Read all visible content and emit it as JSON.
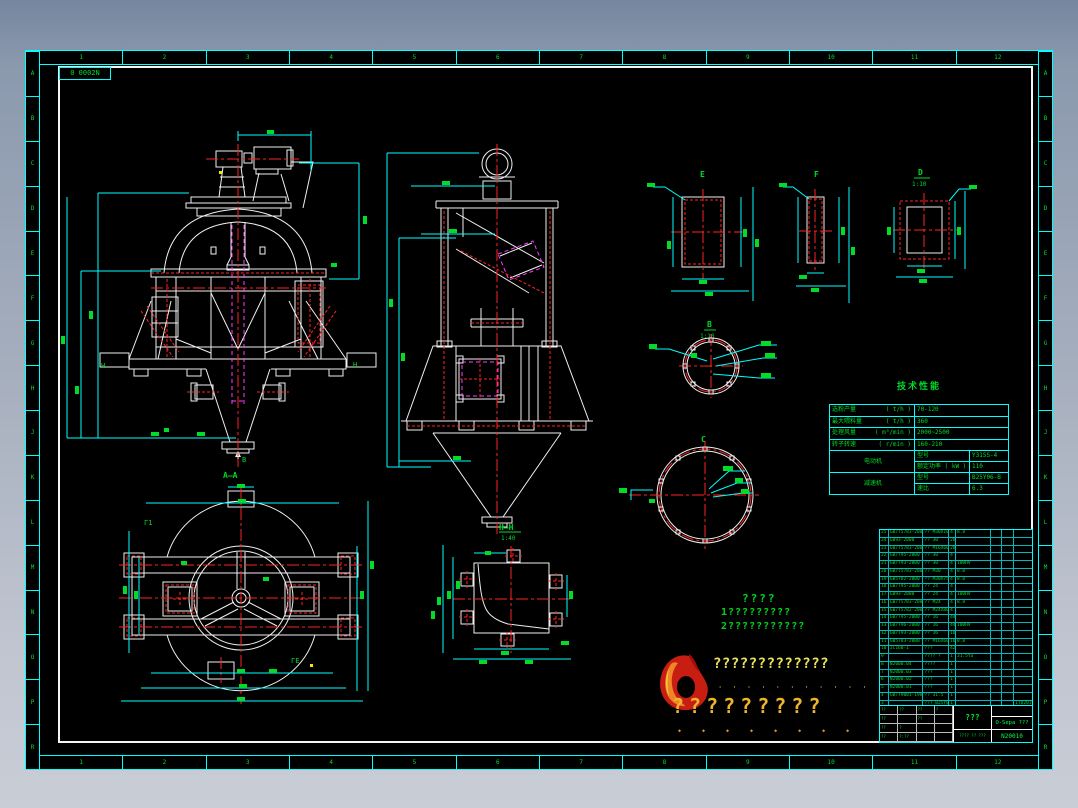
{
  "frame": {
    "sheet_label": "0 0002N"
  },
  "rulers": {
    "h": [
      "1",
      "2",
      "3",
      "4",
      "5",
      "6",
      "7",
      "8",
      "9",
      "10",
      "11",
      "12"
    ],
    "v": [
      "A",
      "B",
      "C",
      "D",
      "E",
      "F",
      "G",
      "H",
      "J",
      "K",
      "L",
      "M",
      "N",
      "O",
      "P",
      "R"
    ]
  },
  "labels": {
    "section_aa": "A—A",
    "b_arrow": "B",
    "h_left": "H",
    "h_right": "H",
    "detail_e": "E",
    "detail_f": "F",
    "detail_d": "D",
    "detail_d_scale": "1:10",
    "detail_b": "B",
    "detail_b_scale": "1:10",
    "detail_c": "C",
    "section_hh": "H—H",
    "section_hh_scale": "1:40",
    "plan_mark1": "Γ1",
    "plan_mark2": "ΓE"
  },
  "tech_table": {
    "title": "技术性能",
    "rows": [
      {
        "name": "选粉产量",
        "unit": "( t/h )",
        "value": "70-120"
      },
      {
        "name": "最大喂料量",
        "unit": "( t/h )",
        "value": "360"
      },
      {
        "name": "处理风量",
        "unit": "( m³/min )",
        "value": "2000~2500"
      },
      {
        "name": "转子转速",
        "unit": "( r/min )",
        "value": "160-210"
      }
    ],
    "motor": {
      "name": "电动机",
      "attr1": "型号",
      "val1": "Y315S-4",
      "attr2": "额定功率 ( kW )",
      "val2": "110"
    },
    "reducer": {
      "name": "减速机",
      "attr1": "型号",
      "val1": "B25Y06-B",
      "attr2": "速比",
      "val2": "6.3"
    }
  },
  "notes": {
    "title": "????",
    "line1": "1?????????",
    "line2": "2???????????"
  },
  "brand": {
    "company": "?????????????",
    "company_ticks": "' ' ' ' ' ' ' ' ' ' '",
    "slogan": "?????????",
    "slogan_ticks": "◆ ◆ ◆ ◆ ◆ ◆ ◆ ◆"
  },
  "bom": {
    "headers": [
      "??",
      "? ?",
      "? ?",
      "?",
      "? ?",
      "??",
      "??",
      "??"
    ],
    "rows": [
      [
        "25",
        "GB/T5783-2000",
        "?? M30X100",
        "4",
        "8.8",
        "",
        "",
        ""
      ],
      [
        "24",
        "GB93-2000",
        "?? 30",
        "20",
        "",
        "",
        "",
        ""
      ],
      [
        "23",
        "GB/T5783-2000",
        "?? M16X60",
        "20",
        "",
        "",
        "",
        ""
      ],
      [
        "22",
        "GB/T95-2000",
        "?? 30",
        "4",
        "",
        "",
        "",
        ""
      ],
      [
        "21",
        "GB/T93-2000",
        "?? 30",
        "4",
        "100HV",
        "",
        "",
        ""
      ],
      [
        "20",
        "GB/T5783-2000",
        "?? M30",
        "4",
        "8.8",
        "",
        "",
        ""
      ],
      [
        "19",
        "GB5782-2000",
        "?? M30X75",
        "4",
        "8.8",
        "",
        "",
        ""
      ],
      [
        "18",
        "GB/T95-2000",
        "?? 24",
        "4",
        "",
        "",
        "",
        ""
      ],
      [
        "17",
        "GB93-2000",
        "?? 24",
        "4",
        "100HV",
        "",
        "",
        ""
      ],
      [
        "16",
        "GB/T5783-2000",
        "?? M24",
        "4",
        "8.8",
        "",
        "",
        ""
      ],
      [
        "15",
        "GB/T5782-2000",
        "?? M24X80",
        "4",
        "",
        "",
        "",
        ""
      ],
      [
        "14",
        "GB/T95-2000",
        "?? 16",
        "44",
        "",
        "",
        "",
        ""
      ],
      [
        "13",
        "GB/T96-2000",
        "?? 16",
        "44",
        "100HV",
        "",
        "",
        ""
      ],
      [
        "12",
        "GB/T93-2000",
        "?? 16",
        "16",
        "",
        "",
        "",
        ""
      ],
      [
        "11",
        "GB5783-2000",
        "?? M16X60",
        "16",
        "8.8",
        "",
        "",
        ""
      ],
      [
        "10",
        "JC160-1",
        "???",
        "42",
        "",
        "",
        "",
        ""
      ],
      [
        "9",
        "",
        "???? ?",
        "1",
        "31.5Ya",
        "",
        "",
        ""
      ],
      [
        "8",
        "N2000.04",
        "????",
        "1",
        "",
        "",
        "",
        ""
      ],
      [
        "7",
        "N2000.03",
        "???",
        "1",
        "",
        "",
        "",
        ""
      ],
      [
        "6",
        "N2000.02",
        "???",
        "1",
        "",
        "",
        "",
        ""
      ],
      [
        "5",
        "N2000.01",
        "???",
        "1",
        "",
        "",
        "",
        ""
      ],
      [
        "4",
        "GB/T9001-1985",
        "?? 31.5",
        "1",
        "",
        "",
        "",
        ""
      ],
      [
        "3",
        "",
        "??? B25Y06-B",
        "1",
        "",
        "",
        "",
        "1TD2010"
      ],
      [
        "2",
        "GB10095-1988",
        "?? 31.5",
        "1",
        "",
        "",
        "",
        ""
      ],
      [
        "1",
        "",
        "?? Y315S-4",
        "1",
        "",
        "",
        "",
        "170kg"
      ]
    ]
  },
  "title_block": {
    "name": "???",
    "product": "O-Sepa ???",
    "code": "N20010",
    "bottom": "???? ?? ???",
    "sig": [
      "??",
      "??",
      "??",
      "?",
      "??",
      "",
      "??",
      "",
      "??",
      "?",
      "",
      "",
      "??",
      "?:??",
      "",
      ""
    ]
  }
}
